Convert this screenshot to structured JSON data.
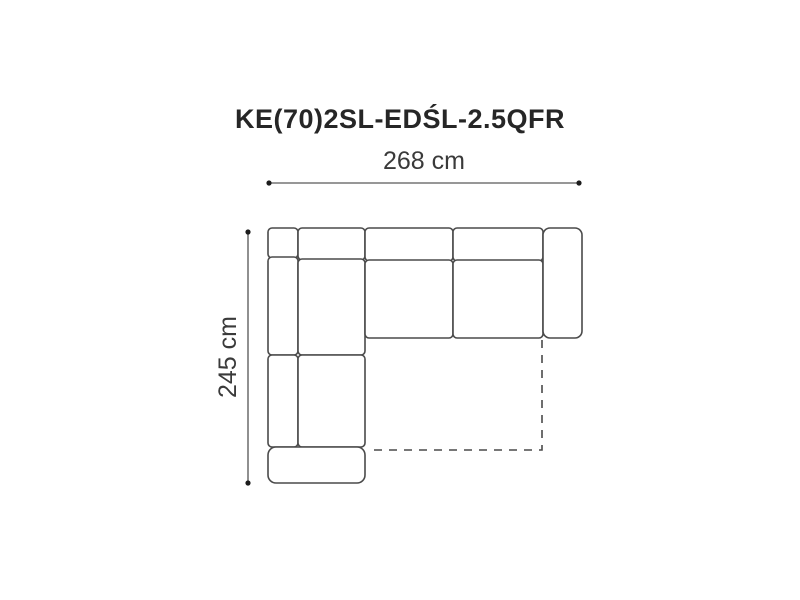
{
  "diagram": {
    "title": "KE(70)2SL-EDŚL-2.5QFR",
    "width_label": "268 cm",
    "height_label": "245 cm",
    "colors": {
      "background": "#ffffff",
      "title_text": "#262626",
      "label_text": "#3a3a3a",
      "sofa_outline": "#4a4a4a",
      "dimension_line": "#757575",
      "dimension_dot": "#1c1c1c"
    },
    "sofa": {
      "modules": [
        {
          "name": "corner-backrest",
          "x": 268,
          "y": 228,
          "w": 30,
          "h": 30,
          "r": 4
        },
        {
          "name": "left-backrest-upper",
          "x": 268,
          "y": 257,
          "w": 30,
          "h": 98,
          "r": 4
        },
        {
          "name": "left-backrest-lower",
          "x": 268,
          "y": 355,
          "w": 30,
          "h": 92,
          "r": 4
        },
        {
          "name": "chaise-backrest",
          "x": 298,
          "y": 228,
          "w": 67,
          "h": 32,
          "r": 4
        },
        {
          "name": "chaise-seat-upper",
          "x": 298,
          "y": 259,
          "w": 67,
          "h": 96,
          "r": 4
        },
        {
          "name": "chaise-seat-lower",
          "x": 298,
          "y": 355,
          "w": 67,
          "h": 92,
          "r": 4
        },
        {
          "name": "chaise-front",
          "x": 268,
          "y": 447,
          "w": 97,
          "h": 36,
          "r": 8
        },
        {
          "name": "seat-left-backrest",
          "x": 365,
          "y": 228,
          "w": 88,
          "h": 33,
          "r": 4
        },
        {
          "name": "seat-left-cushion",
          "x": 365,
          "y": 260,
          "w": 88,
          "h": 78,
          "r": 4
        },
        {
          "name": "seat-right-backrest",
          "x": 453,
          "y": 228,
          "w": 90,
          "h": 33,
          "r": 4
        },
        {
          "name": "seat-right-cushion",
          "x": 453,
          "y": 260,
          "w": 90,
          "h": 78,
          "r": 4
        },
        {
          "name": "right-armrest",
          "x": 543,
          "y": 228,
          "w": 39,
          "h": 110,
          "r": 7
        }
      ],
      "bed_outline": {
        "path": "M 542 340 L 542 450 L 368 450",
        "dash": "8 7"
      }
    },
    "dimensions": {
      "width": {
        "x1": 269,
        "y1": 183,
        "x2": 579,
        "y2": 183
      },
      "height": {
        "x1": 248,
        "y1": 232,
        "x2": 248,
        "y2": 483
      },
      "dot_radius": 2.6
    }
  }
}
